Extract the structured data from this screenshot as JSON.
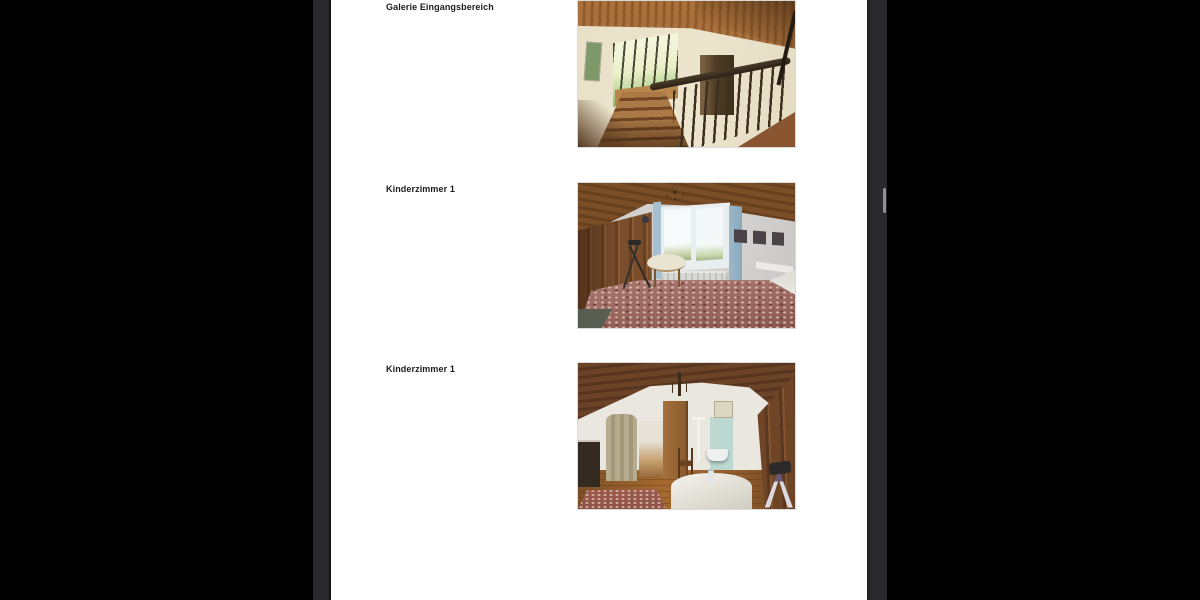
{
  "viewer": {
    "outer_background": "#000000",
    "background_color": "#2a2a2e",
    "page_background": "#ffffff",
    "scrollbar_thumb_color": "#8f8f93"
  },
  "document": {
    "caption_color": "#1c1c1c",
    "entries": [
      {
        "label": "Galerie Eingangsbereich",
        "photo": "staircase-entrance-gallery"
      },
      {
        "label": "Kinderzimmer 1",
        "photo": "childrens-room-view-1"
      },
      {
        "label": "Kinderzimmer 1",
        "photo": "childrens-room-view-2"
      }
    ]
  }
}
